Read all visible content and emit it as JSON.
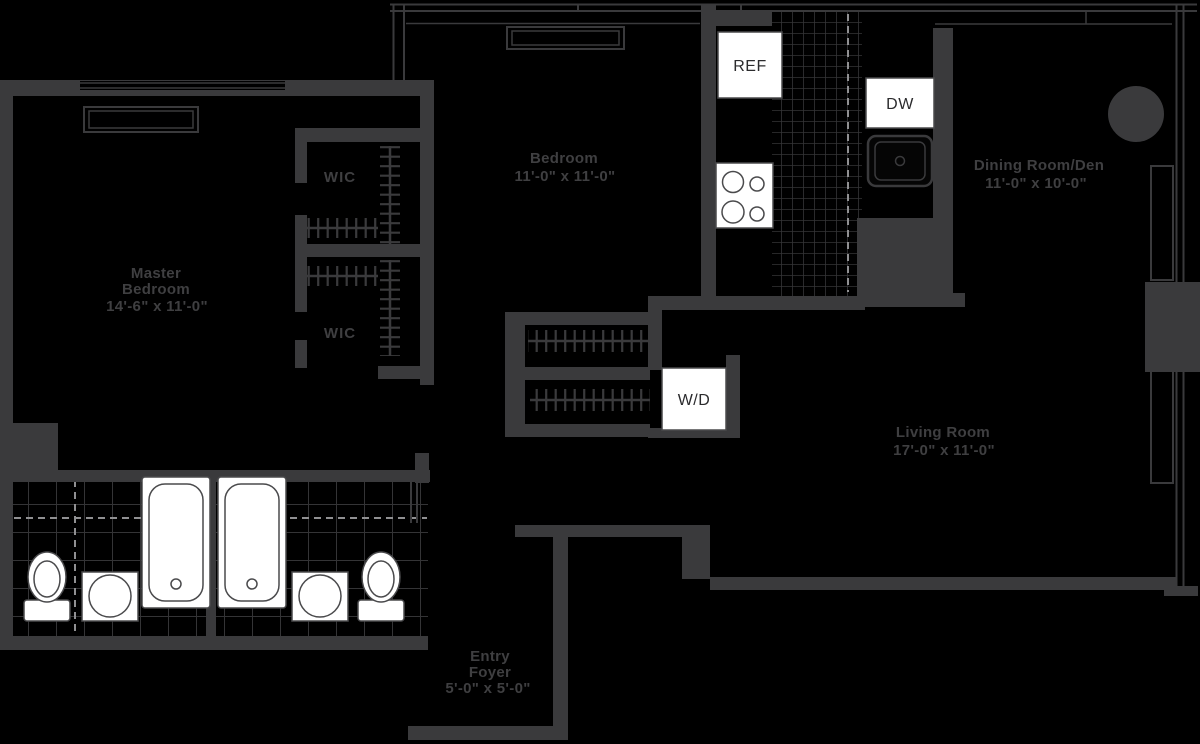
{
  "document_type": "apartment floor plan",
  "colors": {
    "background": "#000000",
    "walls": "#3a3a3c",
    "room_labels": "#3f3f41",
    "fixture_fill": "#ffffff",
    "fixture_outline": "#4a4a4c",
    "tile_grid": "#343436",
    "dashed_lines": "#909092",
    "fixture_text": "#2b2b2d"
  },
  "rooms": {
    "master_bedroom": {
      "name": "Master Bedroom",
      "dimensions": "14'-6\" x 11'-0\"",
      "lines": [
        "Master",
        "Bedroom",
        "14'-6\" x 11'-0\""
      ]
    },
    "bedroom": {
      "name": "Bedroom",
      "dimensions": "11'-0\" x 11'-0\"",
      "lines": [
        "Bedroom",
        "11'-0\" x 11'-0\""
      ]
    },
    "dining_room_den": {
      "name": "Dining Room/Den",
      "dimensions": "11'-0\" x 10'-0\"",
      "lines": [
        "Dining Room/Den",
        "11'-0\" x 10'-0\""
      ]
    },
    "living_room": {
      "name": "Living Room",
      "dimensions": "17'-0\" x 11'-0\"",
      "lines": [
        "Living Room",
        "17'-0\" x 11'-0\""
      ]
    },
    "entry_foyer": {
      "name": "Entry Foyer",
      "dimensions": "5'-0\" x 5'-0\"",
      "lines": [
        "Entry",
        "Foyer",
        "5'-0\" x 5'-0\""
      ]
    },
    "wic_upper": {
      "name": "WIC"
    },
    "wic_lower": {
      "name": "WIC"
    }
  },
  "appliances": {
    "refrigerator": {
      "label": "REF"
    },
    "dishwasher": {
      "label": "DW"
    },
    "washer_dryer": {
      "label": "W/D"
    }
  },
  "symbols": [
    "four-burner-stove",
    "kitchen-sink",
    "structural-column",
    "bathtub-left",
    "bathtub-right",
    "toilet-left",
    "toilet-right",
    "vanity-sink-left",
    "vanity-sink-right",
    "closet-hanging-rods",
    "window-glazing",
    "ptac-window-units",
    "kitchen-tile-floor",
    "bathroom-tile-floor"
  ]
}
